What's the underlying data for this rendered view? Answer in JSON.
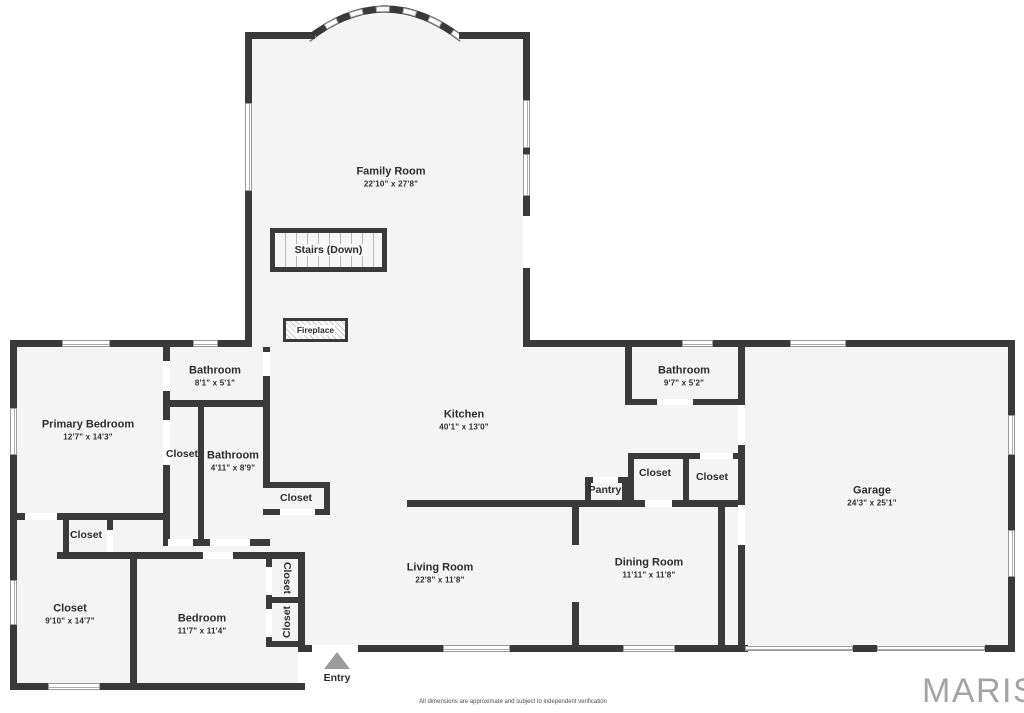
{
  "branding": {
    "logo_text": "MARIS",
    "disclaimer": "All dimensions are approximate and subject to independent verification"
  },
  "rooms": {
    "family_room": {
      "name": "Family Room",
      "dims": "22'10\" x 27'8\""
    },
    "stairs": {
      "name": "Stairs (Down)"
    },
    "fireplace": {
      "name": "Fireplace"
    },
    "bathroom_top": {
      "name": "Bathroom",
      "dims": "8'1\" x 5'1\""
    },
    "primary_bedroom": {
      "name": "Primary Bedroom",
      "dims": "12'7\" x 14'3\""
    },
    "closet_primary": {
      "name": "Closet"
    },
    "bathroom_mid": {
      "name": "Bathroom",
      "dims": "4'11\" x 8'9\""
    },
    "closet_hall": {
      "name": "Closet"
    },
    "kitchen": {
      "name": "Kitchen",
      "dims": "40'1\" x 13'0\""
    },
    "bathroom_right": {
      "name": "Bathroom",
      "dims": "9'7\" x 5'2\""
    },
    "closet_r1": {
      "name": "Closet"
    },
    "closet_r2": {
      "name": "Closet"
    },
    "pantry": {
      "name": "Pantry"
    },
    "garage": {
      "name": "Garage",
      "dims": "24'3\" x 25'1\""
    },
    "closet_small": {
      "name": "Closet"
    },
    "closet_large": {
      "name": "Closet",
      "dims": "9'10\" x 14'7\""
    },
    "bedroom": {
      "name": "Bedroom",
      "dims": "11'7\" x 11'4\""
    },
    "closet_v1": {
      "name": "Closet"
    },
    "closet_v2": {
      "name": "Closet"
    },
    "living_room": {
      "name": "Living Room",
      "dims": "22'8\" x 11'8\""
    },
    "dining_room": {
      "name": "Dining Room",
      "dims": "11'11\" x 11'8\""
    },
    "entry": {
      "name": "Entry"
    }
  },
  "colors": {
    "wall": "#3a3a3a",
    "floor_fill": "#f4f4f4",
    "window": "#ffffff",
    "logo": "#a3a3a3",
    "entry_marker": "#9b9b9b"
  }
}
